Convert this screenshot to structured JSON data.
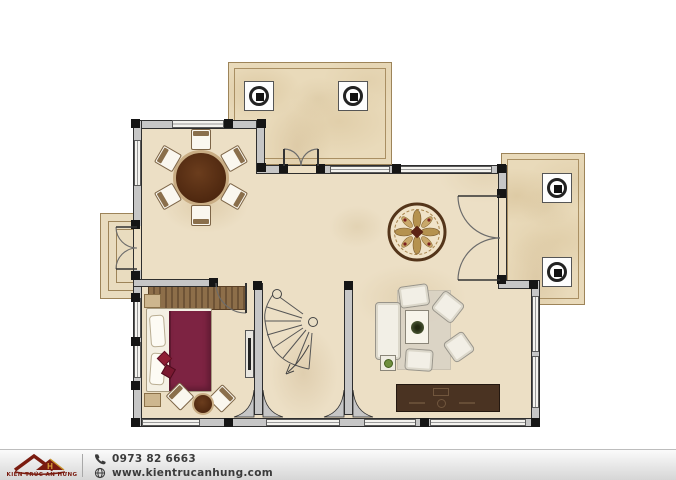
{
  "meta": {
    "width": 676,
    "height": 480,
    "type": "house-ground-floor-plan"
  },
  "colors": {
    "floor_marble": "#ecdfc5",
    "wall_fill": "#c6c6c6",
    "wall_edge": "#2e2e2e",
    "terrace_border": "#9d8459",
    "dining_table_wood": "#5a3018",
    "bed_cover_maroon": "#7d2342",
    "wardrobe_wood": "#8d6e49",
    "tv_cabinet_wood": "#4a3322",
    "medallion_ring": "#54351a",
    "brand_maroon": "#7a1c10",
    "brand_gold": "#d9a43a",
    "footer_text": "#3b3b3b"
  },
  "footer": {
    "brand_name": "KIẾN TRÚC AN HƯNG",
    "logo_letter": "H",
    "phone": "0973 82 6663",
    "website": "www.kientrucanhung.com",
    "icons": {
      "phone": "phone-icon",
      "website": "globe-icon",
      "logo": "roof-logo-icon"
    }
  }
}
